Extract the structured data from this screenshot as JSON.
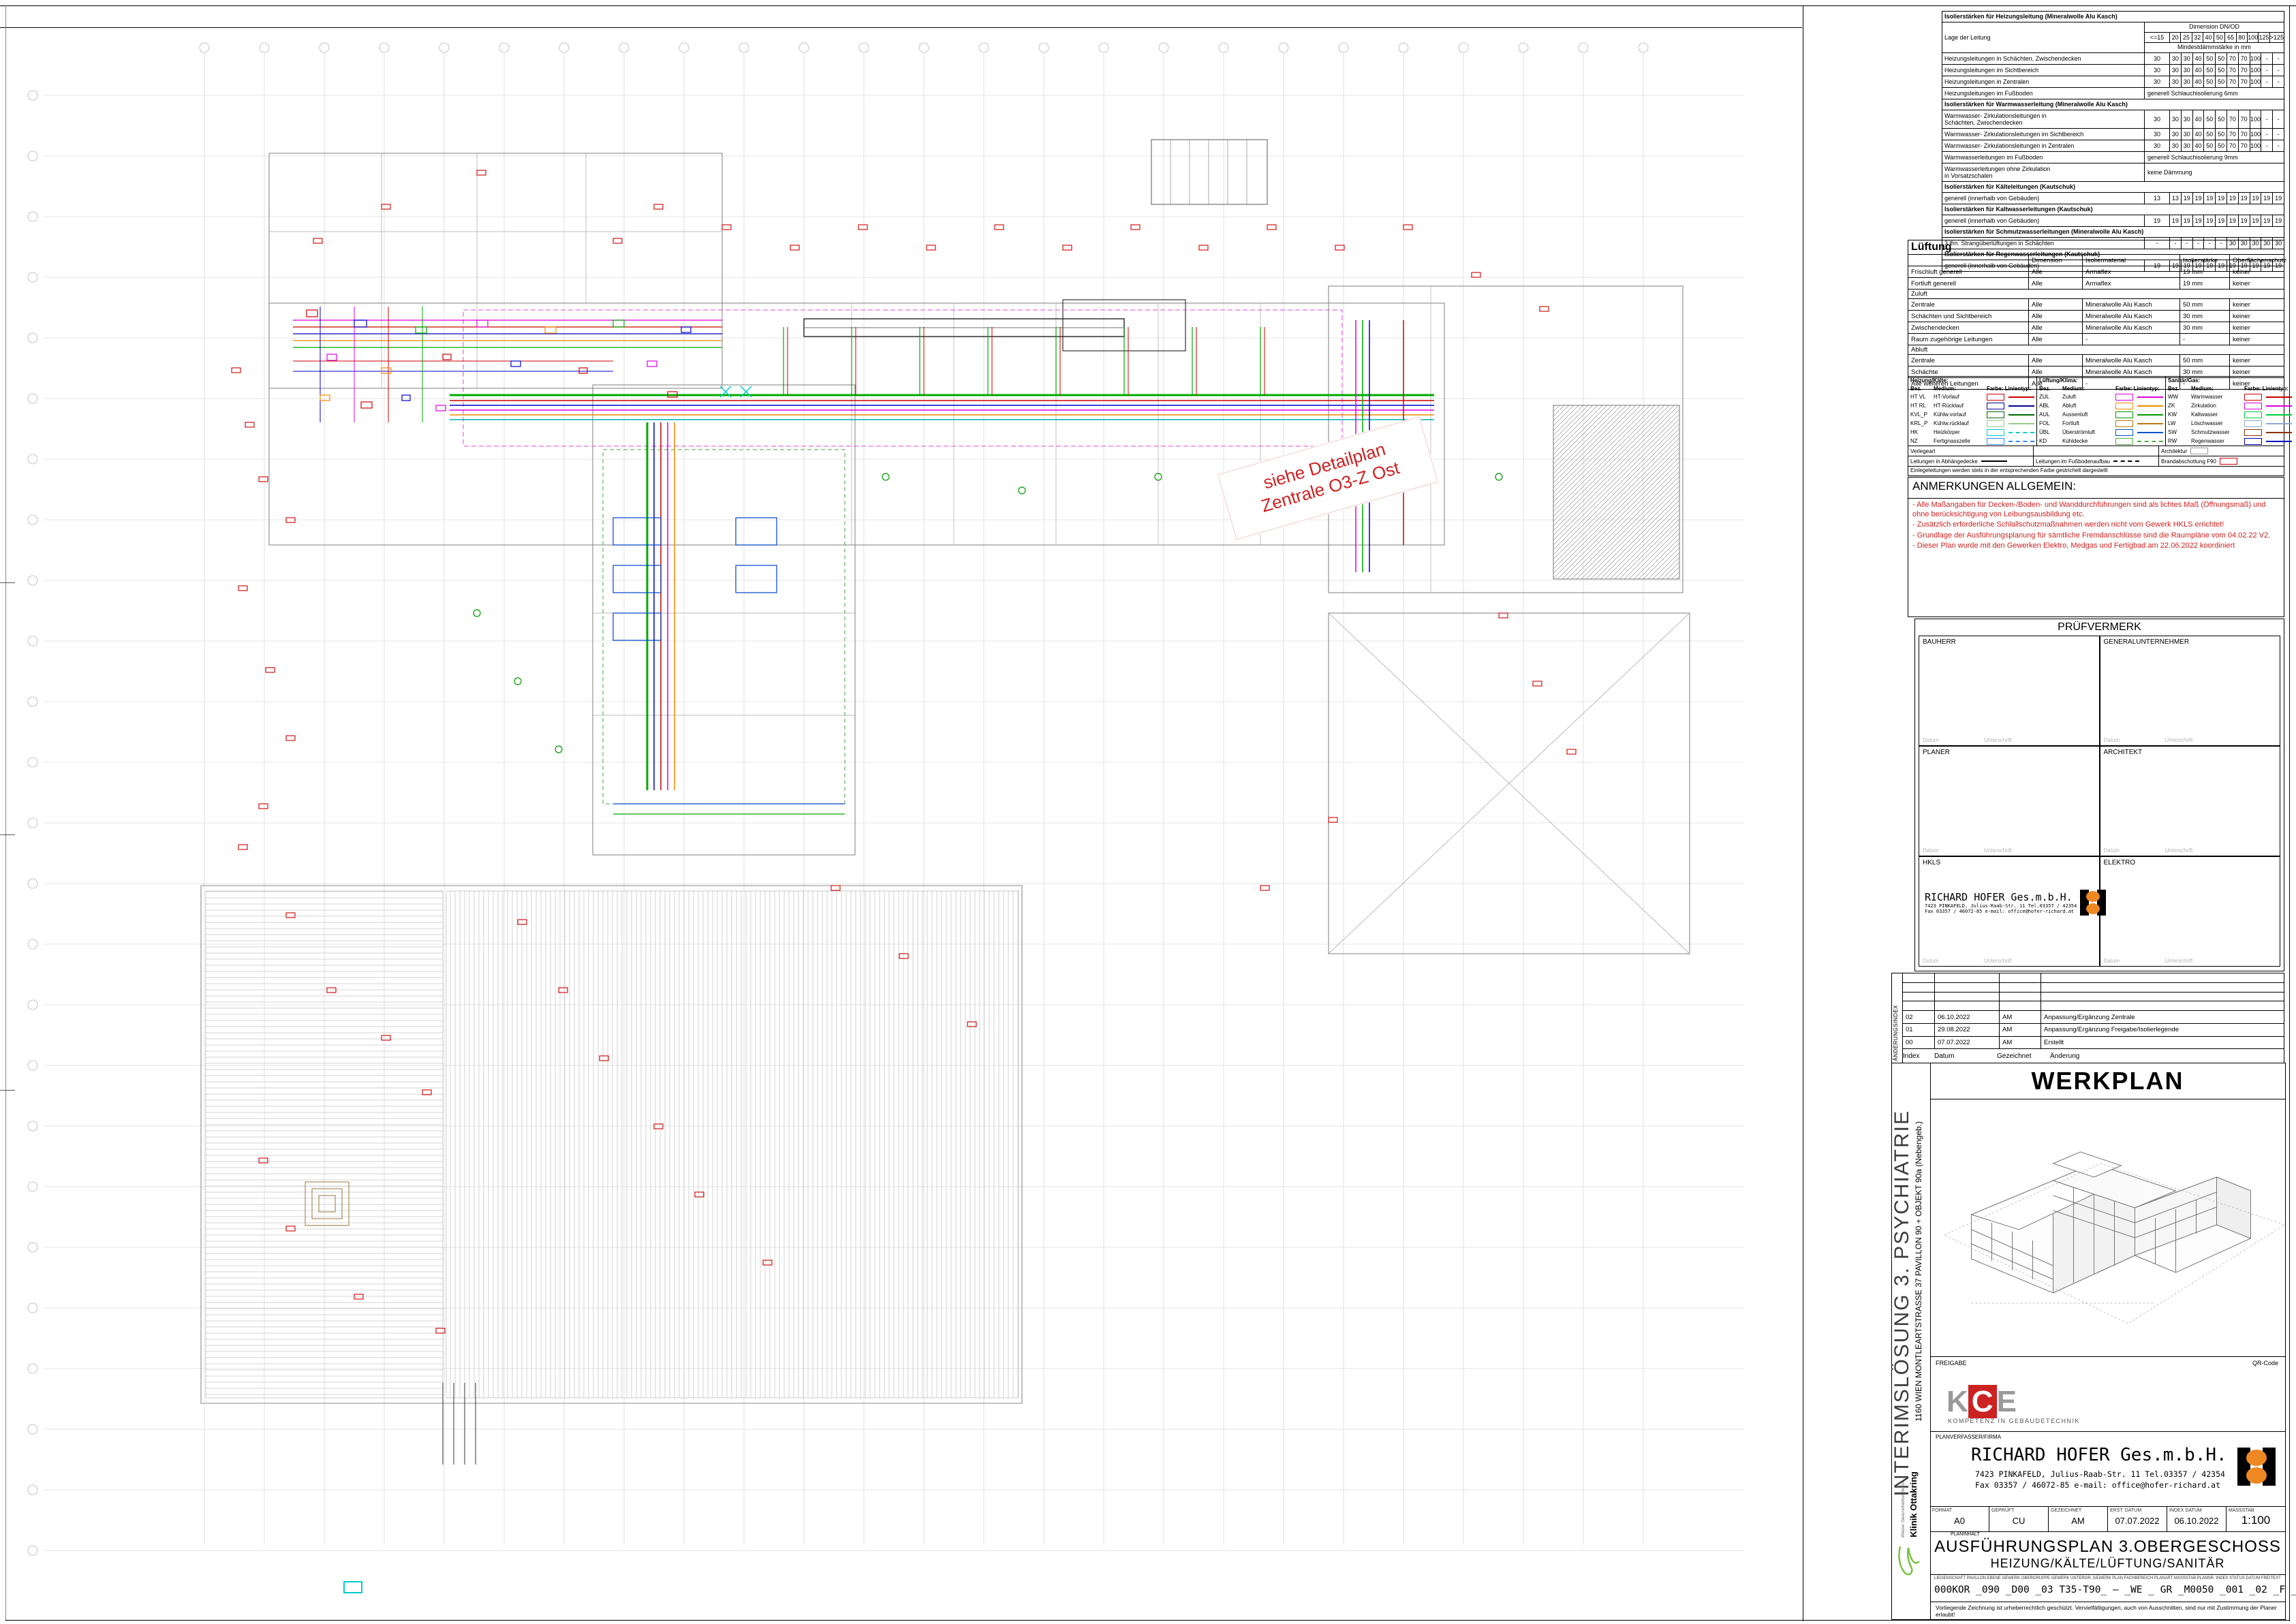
{
  "plan": {
    "stamp_line1": "siehe Detailplan",
    "stamp_line2": "Zentrale O3-Z Ost"
  },
  "insulation": {
    "lage_label": "Lage der Leitung",
    "dim_label": "Dimension DN/OD",
    "dims": [
      "<=15",
      "20",
      "25",
      "32",
      "40",
      "50",
      "65",
      "80",
      "100",
      "125",
      ">125"
    ],
    "mindest_label": "Mindestdämmstärke in mm",
    "rows": [
      {
        "t": "title",
        "x": "Isolierstärken für Heizungsleitung (Mineralwolle Alu Kasch)"
      },
      {
        "t": "head"
      },
      {
        "t": "r",
        "l": "Heizungsleitungen in Schächten, Zwischendecken",
        "v": [
          "30",
          "30",
          "30",
          "40",
          "50",
          "50",
          "70",
          "70",
          "100",
          "-",
          "-"
        ]
      },
      {
        "t": "r",
        "l": "Heizungsleitungen im Sichtbereich",
        "v": [
          "30",
          "30",
          "30",
          "40",
          "50",
          "50",
          "70",
          "70",
          "100",
          "-",
          "-"
        ]
      },
      {
        "t": "r",
        "l": "Heizungsleitungen in Zentralen",
        "v": [
          "30",
          "30",
          "30",
          "40",
          "50",
          "50",
          "70",
          "70",
          "100",
          "-",
          "-"
        ]
      },
      {
        "t": "s",
        "l": "Heizungsleitungen im Fußboden",
        "x": "generell Schlauchisolierung 6mm"
      },
      {
        "t": "title",
        "x": "Isolierstärken für Warmwasserleitung (Mineralwolle Alu Kasch)"
      },
      {
        "t": "r",
        "l": "Warmwasser- Zirkulationsleitungen in\nSchächten, Zwischendecken",
        "v": [
          "30",
          "30",
          "30",
          "40",
          "50",
          "50",
          "70",
          "70",
          "100",
          "-",
          "-"
        ],
        "h": 24
      },
      {
        "t": "r",
        "l": "Warmwasser- Zirkulationsleitungen im Sichtbereich",
        "v": [
          "30",
          "30",
          "30",
          "40",
          "50",
          "50",
          "70",
          "70",
          "100",
          "-",
          "-"
        ]
      },
      {
        "t": "r",
        "l": "Warmwasser- Zirkulationsleitungen in Zentralen",
        "v": [
          "30",
          "30",
          "30",
          "40",
          "50",
          "50",
          "70",
          "70",
          "100",
          "-",
          "-"
        ]
      },
      {
        "t": "s",
        "l": "Warmwasserleitungen im Fußboden",
        "x": "generell Schlauchisolierung 9mm"
      },
      {
        "t": "s",
        "l": "Warmwasserleitungen ohne Zirkulation\nin Vorsatzschalen",
        "x": "keine Dämmung",
        "h": 24
      },
      {
        "t": "title",
        "x": "Isolierstärken für Kälteleitungen (Kautschuk)"
      },
      {
        "t": "r",
        "l": "generell (innerhalb von Gebäuden)",
        "v": [
          "13",
          "13",
          "19",
          "19",
          "19",
          "19",
          "19",
          "19",
          "19",
          "19",
          "19"
        ]
      },
      {
        "t": "title",
        "x": "Isolierstärken für Kaltwasserleitungen (Kautschuk)"
      },
      {
        "t": "r",
        "l": "generell (innerhalb von Gebäuden)",
        "v": [
          "19",
          "19",
          "19",
          "19",
          "19",
          "19",
          "19",
          "19",
          "19",
          "19",
          "19"
        ]
      },
      {
        "t": "title",
        "x": "Isolierstärken für Schmutzwasserleitungen (Mineralwolle Alu Kasch)"
      },
      {
        "t": "r",
        "l": "3 lfm. Strangüberlüftungen in Schächten",
        "v": [
          "-",
          "-",
          "-",
          "-",
          "-",
          "-",
          "30",
          "30",
          "30",
          "30",
          "30"
        ]
      },
      {
        "t": "title",
        "x": "Isolierstärken für Regenwasserleitungen (Kautschuk)"
      },
      {
        "t": "r",
        "l": "generell (innerhalb von Gebäuden)",
        "v": [
          "19",
          "19",
          "19",
          "19",
          "19",
          "19",
          "19",
          "19",
          "19",
          "19",
          "19"
        ]
      }
    ]
  },
  "lueftung": {
    "title": "Lüftung",
    "headers": [
      "Dimension",
      "Isoliermaterial",
      "Isolierstärke",
      "Oberflächenschutz"
    ],
    "rows": [
      {
        "c": [
          "Frischluft generell",
          "Alle",
          "Armaflex",
          "19 mm",
          "keiner"
        ]
      },
      {
        "c": [
          "Fortluft generell",
          "Alle",
          "Armaflex",
          "19 mm",
          "keiner"
        ]
      },
      {
        "sub": "Zuluft"
      },
      {
        "c": [
          "Zentrale",
          "Alle",
          "Mineralwolle Alu Kasch",
          "50 mm",
          "keiner"
        ]
      },
      {
        "c": [
          "Schächten und Sichtbereich",
          "Alle",
          "Mineralwolle Alu Kasch",
          "30 mm",
          "keiner"
        ]
      },
      {
        "c": [
          "Zwischendecken",
          "Alle",
          "Mineralwolle Alu Kasch",
          "30 mm",
          "keiner"
        ]
      },
      {
        "c": [
          "Raum zugehörige Leitungen",
          "Alle",
          "-",
          "-",
          "keiner"
        ]
      },
      {
        "sub": "Abluft"
      },
      {
        "c": [
          "Zentrale",
          "Alle",
          "Mineralwolle Alu Kasch",
          "50 mm",
          "keiner"
        ]
      },
      {
        "c": [
          "Schächte",
          "Alle",
          "Mineralwolle Alu Kasch",
          "30 mm",
          "keiner"
        ]
      },
      {
        "c": [
          "Alle weiteren Leitungen",
          "Alle",
          "-",
          "-",
          "keiner"
        ]
      }
    ]
  },
  "legend": {
    "col_headers": [
      "Bez.",
      "Medium:",
      "Farbe:",
      "Linientyp:"
    ],
    "groups": [
      {
        "title": "Heizung/Kälte:",
        "items": [
          {
            "b": "HT VL",
            "m": "HT-Vorlauf",
            "col": "#cc0000",
            "d": 0
          },
          {
            "b": "HT RL",
            "m": "HT-Rücklauf",
            "col": "#000099",
            "d": 0
          },
          {
            "b": "KVL_P",
            "m": "Kühlw.vorlauf",
            "col": "#006600",
            "d": 0
          },
          {
            "b": "KRL_P",
            "m": "Kühlw.rücklauf",
            "col": "#99cc88",
            "d": 0
          },
          {
            "b": "HK",
            "m": "Heizkörper",
            "col": "#00cccc",
            "d": 1
          },
          {
            "b": "NZ",
            "m": "Fertignasszelle",
            "col": "#3388ff",
            "d": 1
          }
        ]
      },
      {
        "title": "Lüftung/Klima:",
        "items": [
          {
            "b": "ZUL",
            "m": "Zuluft",
            "col": "#dd00dd",
            "d": 0
          },
          {
            "b": "ABL",
            "m": "Abluft",
            "col": "#ee8800",
            "d": 0
          },
          {
            "b": "AUL",
            "m": "Aussenluft",
            "col": "#009900",
            "d": 0
          },
          {
            "b": "FOL",
            "m": "Fortluft",
            "col": "#bb7711",
            "d": 0
          },
          {
            "b": "ÜBL",
            "m": "Überströmluft",
            "col": "#0055cc",
            "d": 0
          },
          {
            "b": "KD",
            "m": "Kühldecke",
            "col": "#55aa44",
            "d": 1
          }
        ]
      },
      {
        "title": "Sanitär/Gas:",
        "items": [
          {
            "b": "WW",
            "m": "Warmwasser",
            "col": "#cc0000",
            "d": 0
          },
          {
            "b": "ZK",
            "m": "Zirkulation",
            "col": "#dd00dd",
            "d": 0
          },
          {
            "b": "KW",
            "m": "Kaltwasser",
            "col": "#00cc44",
            "d": 0
          },
          {
            "b": "LW",
            "m": "Löschwasser",
            "col": "#88aacc",
            "d": 0
          },
          {
            "b": "SW",
            "m": "Schmutzwasser",
            "col": "#883300",
            "d": 0
          },
          {
            "b": "RW",
            "m": "Regenwasser",
            "col": "#0000bb",
            "d": 0
          }
        ]
      }
    ],
    "extra": {
      "verlegeart": "Verlegeart",
      "architektur": "Architektur",
      "architektur_col": "#999999",
      "abhaenge": "Leitungen in Abhängedecke",
      "fussboden": "Leitungen im Fußbodenaufbau",
      "brand": "Brandabschottung F90",
      "brand_col": "#cc0000",
      "note": "Einlegeleitungen werden stets in der entsprechenden Farbe gestrichelt dargestellt"
    }
  },
  "notes": {
    "title": "ANMERKUNGEN ALLGEMEIN:",
    "items": [
      "- Alle Maßangaben für Decken-/Boden- und Wanddurchführungen sind  als lichtes Maß (Öffnungsmaß) und ohne berücksichtigung von Leibungsausbildung etc.",
      "- Zusätzlich erforderliche Schlallschutzmaßnahmen werden nicht vom Gewerk HKLS errichtet!",
      "- Grundlage der Ausführungsplanung für sämtliche Fremdanschlüsse sind die Raumpläne vom 04.02.22 V2.",
      "- Dieser Plan wurde mit den Gewerken Elektro, Medgas und Fertigbad am 22.06.2022 koordiniert"
    ]
  },
  "pruef": {
    "title": "PRÜFVERMERK",
    "cells": [
      "BAUHERR",
      "GENERALUNTERNEHMER",
      "PLANER",
      "ARCHITEKT",
      "HKLS",
      "ELEKTRO"
    ],
    "datum": "Datum",
    "unterschrift": "Unterschrift",
    "stamp": {
      "name": "RICHARD HOFER Ges.m.b.H.",
      "addr1": "7423 PINKAFELD, Julius-Raab-Str. 11 Tel.03357 / 42354",
      "addr2": "Fax 03357 / 46072-85  e-mail: office@hofer-richard.at"
    }
  },
  "revisions": {
    "vertical_label": "ÄNDERUNGSINDEX",
    "empty_rows": 4,
    "rows": [
      [
        "02",
        "06.10.2022",
        "AM",
        "Anpassung/Ergänzung Zentrale"
      ],
      [
        "01",
        "29.08.2022",
        "AM",
        "Anpassung/Ergänzung Freigabe/Isolierlegende"
      ],
      [
        "00",
        "07.07.2022",
        "AM",
        "Erstellt"
      ]
    ],
    "footer": [
      "Index",
      "Datum",
      "Gezeichnet",
      "Änderung"
    ]
  },
  "titleblock": {
    "project_vertical": "INTERIMSLÖSUNG  3. PSYCHIATRIE",
    "address_vertical": "1160 WIEN MONTLEARTSTRASSE 37 PAVILLON 90 + OBJEKT 90a (Nebengeb.)",
    "werkplan": "WERKPLAN",
    "freigabe": "FREIGABE",
    "qr": "QR-Code",
    "kce_letters": [
      "K",
      "C",
      "E"
    ],
    "kce_sub": "KOMPETENZ IN GEBÄUDETECHNIK",
    "klinik": "Klinik Ottakring",
    "klinik_sub": "Wiener Gesundheitsverbund",
    "planverfasser": "PLANVERFASSER/FIRMA",
    "firm_name": "RICHARD HOFER Ges.m.b.H.",
    "firm_addr1": "7423 PINKAFELD, Julius-Raab-Str. 11 Tel.03357 / 42354",
    "firm_addr2": "Fax 03357 / 46072-85  e-mail: office@hofer-richard.at",
    "fields": [
      {
        "label": "FORMAT",
        "value": "A0"
      },
      {
        "label": "GEPRÜFT",
        "value": "CU"
      },
      {
        "label": "GEZEICHNET",
        "value": "AM"
      },
      {
        "label": "ERST. DATUM",
        "value": "07.07.2022"
      },
      {
        "label": "INDEX DATUM",
        "value": "06.10.2022"
      },
      {
        "label": "MASSSTAB",
        "value": "1:100",
        "big": true
      }
    ],
    "planinhalt_label": "PLANINHALT",
    "plan_title1": "AUSFÜHRUNGSPLAN 3.OBERGESCHOSS",
    "plan_title2": "HEIZUNG/KÄLTE/LÜFTUNG/SANITÄR",
    "plannr_headers": [
      "LIEGENSCHAFT",
      "PAVILLON",
      "EBENE",
      "GEWERK OBERGRUPPE",
      "GEWERK UNTERGR.",
      "GEWERK PLAN",
      "FACHBEREICH",
      "PLANART",
      "MASSSTAB",
      "PLANNR.",
      "INDEX",
      "STATUS",
      "DATUM",
      "FREITEXT"
    ],
    "plannr_value": "000KOR _090 _D00 _03 T35-T90_ – _WE _ GR _M0050 _001 _02 _F _20221006 _O3-HKLS",
    "copyright": "Vorliegende Zeichnung ist urheberrechtlich geschützt. Vervielfältigungen, auch von Ausschnitten, sind nur mit Zustimmung der Planer erlaubt!"
  }
}
